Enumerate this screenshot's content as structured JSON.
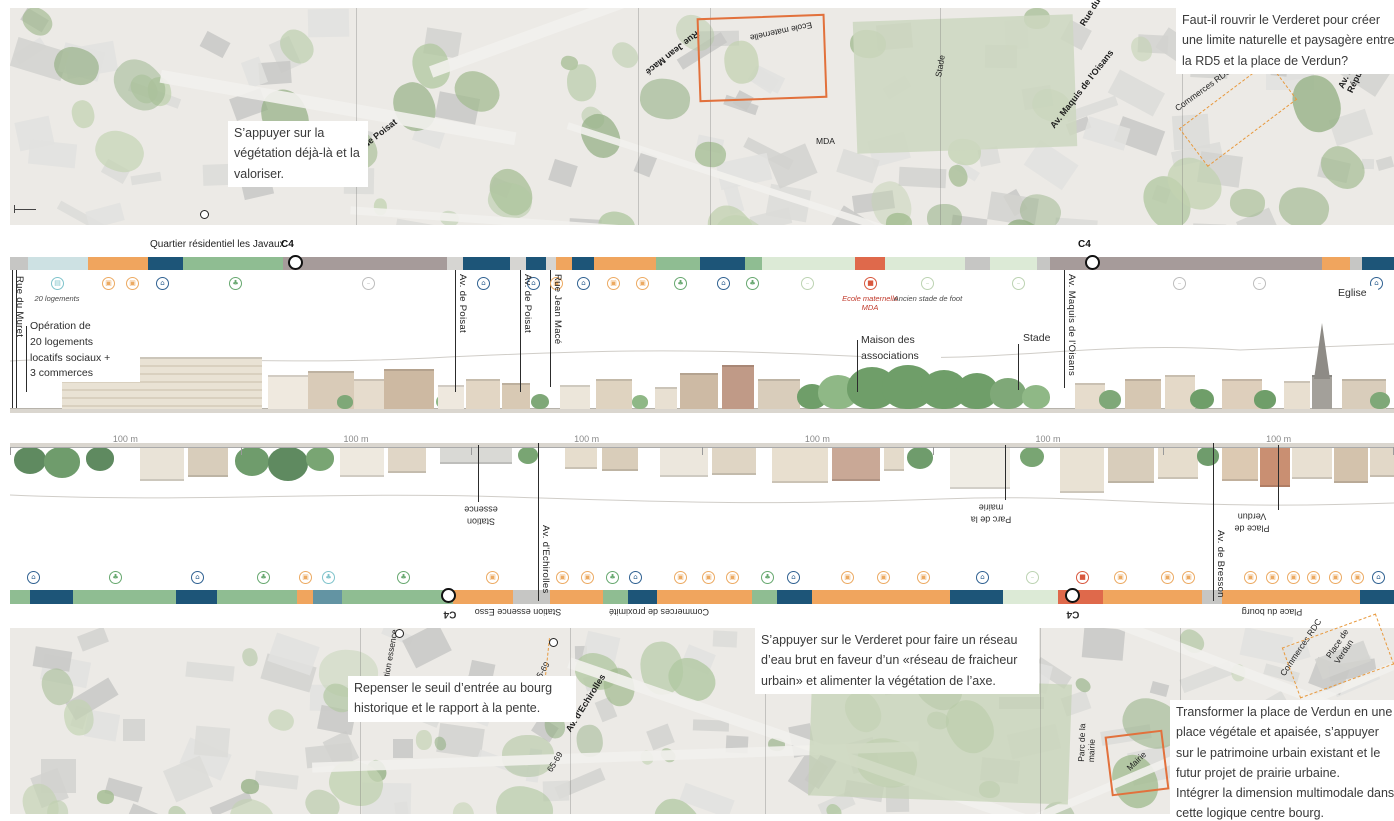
{
  "palette": {
    "gray": "#c6c6c4",
    "lgray": "#d6d5d2",
    "lblue": "#cde1e3",
    "orange": "#f0a55e",
    "navy": "#1d5578",
    "green": "#8fbd92",
    "mauve": "#a69b9a",
    "pgreen": "#dcead6",
    "red": "#df694b",
    "slate": "#6394a3",
    "icon_orange": "#ecaa62",
    "icon_navy": "#2f6191",
    "icon_green": "#67a86f",
    "icon_gray": "#bdbdbd",
    "icon_teal": "#7fc3cb",
    "icon_red": "#d8573d",
    "icon_pale": "#bcd3b2",
    "annotation_orange": "#e2713c"
  },
  "top_map": {
    "notes": [
      {
        "text": "S’appuyer sur la végétation déjà-là et la valoriser.",
        "x": 228,
        "y": 121,
        "w": 128
      },
      {
        "text": "Faut-il rouvrir le Verderet pour créer une limite naturelle et paysagère entre la RD5 et la place de Verdun?",
        "x": 1176,
        "y": 8,
        "w": 214
      }
    ],
    "road_labels": [
      {
        "text": "Av. de Poisat",
        "x": 352,
        "y": 150,
        "rot": -38,
        "bold": true
      },
      {
        "text": "Rue Jean Macé",
        "x": 698,
        "y": 28,
        "rot": 142,
        "bold": true
      },
      {
        "text": "Ecole maternelle",
        "x": 812,
        "y": 20,
        "rot": 168,
        "bold": false
      },
      {
        "text": "MDA",
        "x": 816,
        "y": 136,
        "rot": 0,
        "bold": false
      },
      {
        "text": "Stade",
        "x": 938,
        "y": 72,
        "rot": -80,
        "bold": false
      },
      {
        "text": "Rue du château",
        "x": 1082,
        "y": 20,
        "rot": -58,
        "bold": true
      },
      {
        "text": "Av. Maquis de l'Oisans",
        "x": 1052,
        "y": 122,
        "rot": -52,
        "bold": true
      },
      {
        "text": "Commerces RDC",
        "x": 1176,
        "y": 104,
        "rot": -36,
        "bold": false
      },
      {
        "text": "Av. de la République",
        "x": 1345,
        "y": 80,
        "rot": -64,
        "bold": true
      }
    ],
    "outlines": [
      {
        "type": "solid",
        "x": 698,
        "y": 16,
        "w": 128,
        "h": 84,
        "rot": -2
      },
      {
        "type": "dash",
        "x": 1182,
        "y": 90,
        "w": 112,
        "h": 48,
        "rot": -37
      }
    ],
    "circle_markers": [
      {
        "x": 200,
        "y": 210
      }
    ]
  },
  "band1": {
    "quartier_label": "Quartier résidentiel les Javaux",
    "c4_label": "C4",
    "c4_label_positions": [
      {
        "x": 281,
        "y": 239
      },
      {
        "x": 1078,
        "y": 239
      }
    ],
    "c4_markers": [
      296,
      1093
    ],
    "segments": [
      [
        18,
        "gray"
      ],
      [
        60,
        "lblue"
      ],
      [
        60,
        "orange"
      ],
      [
        35,
        "navy"
      ],
      [
        100,
        "green"
      ],
      [
        164,
        "mauve"
      ],
      [
        16,
        "lgray"
      ],
      [
        47,
        "navy"
      ],
      [
        16,
        "lgray"
      ],
      [
        20,
        "navy"
      ],
      [
        10,
        "lgray"
      ],
      [
        16,
        "orange"
      ],
      [
        22,
        "navy"
      ],
      [
        62,
        "orange"
      ],
      [
        44,
        "green"
      ],
      [
        45,
        "navy"
      ],
      [
        17,
        "green"
      ],
      [
        93,
        "pgreen"
      ],
      [
        30,
        "red"
      ],
      [
        80,
        "pgreen"
      ],
      [
        25,
        "gray"
      ],
      [
        47,
        "pgreen"
      ],
      [
        13,
        "gray"
      ],
      [
        272,
        "mauve"
      ],
      [
        28,
        "orange"
      ],
      [
        12,
        "gray"
      ],
      [
        32,
        "navy"
      ]
    ],
    "icons": [
      [
        57,
        "icon_teal",
        "building"
      ],
      [
        108,
        "icon_orange",
        "shop"
      ],
      [
        132,
        "icon_orange",
        "shop"
      ],
      [
        162,
        "icon_navy",
        "house"
      ],
      [
        235,
        "icon_green",
        "tree"
      ],
      [
        368,
        "icon_gray",
        "neutral"
      ],
      [
        483,
        "icon_navy",
        "house"
      ],
      [
        533,
        "icon_navy",
        "house"
      ],
      [
        556,
        "icon_orange",
        "shop"
      ],
      [
        583,
        "icon_navy",
        "house"
      ],
      [
        613,
        "icon_orange",
        "shop"
      ],
      [
        642,
        "icon_orange",
        "shop"
      ],
      [
        680,
        "icon_green",
        "tree"
      ],
      [
        723,
        "icon_navy",
        "house"
      ],
      [
        752,
        "icon_green",
        "tree"
      ],
      [
        807,
        "icon_pale",
        "neutral"
      ],
      [
        870,
        "icon_red",
        "school"
      ],
      [
        927,
        "icon_pale",
        "neutral"
      ],
      [
        1018,
        "icon_pale",
        "neutral"
      ],
      [
        1179,
        "icon_gray",
        "neutral"
      ],
      [
        1259,
        "icon_gray",
        "neutral"
      ],
      [
        1376,
        "icon_navy",
        "house"
      ]
    ],
    "icon_captions": [
      {
        "text": "20 logements",
        "x": 57,
        "y": 294,
        "color": "#4a4a4a"
      },
      {
        "text": "Ecole maternelle\nMDA",
        "x": 870,
        "y": 294,
        "color": "#c0392b"
      },
      {
        "text": "Ancien stade de foot",
        "x": 928,
        "y": 294,
        "color": "#4a4a4a"
      }
    ],
    "streets": [
      {
        "name": "Rue du Muret",
        "x": 12,
        "y1": 270,
        "y2": 408,
        "ly": 276
      },
      {
        "name": "",
        "x": 16,
        "y1": 270,
        "y2": 408,
        "ly": 0
      },
      {
        "name": "",
        "x": 26,
        "y1": 326,
        "y2": 392,
        "ly": 0
      },
      {
        "name": "Av. de Poisat",
        "x": 455,
        "y1": 270,
        "y2": 392,
        "ly": 274
      },
      {
        "name": "Av. de Poisat",
        "x": 520,
        "y1": 270,
        "y2": 392,
        "ly": 274
      },
      {
        "name": "Rue Jean Macé",
        "x": 550,
        "y1": 270,
        "y2": 387,
        "ly": 274
      },
      {
        "name": "Av. Maquis de l'Oisans",
        "x": 1064,
        "y1": 270,
        "y2": 388,
        "ly": 274
      },
      {
        "name": "",
        "x": 857,
        "y1": 340,
        "y2": 392,
        "ly": 0
      },
      {
        "name": "",
        "x": 1018,
        "y1": 344,
        "y2": 390,
        "ly": 0
      }
    ],
    "callouts": [
      {
        "text": "Opération de\n20 logements\nlocatifs sociaux +\n3 commerces",
        "x": 30,
        "y": 319,
        "w": 110
      },
      {
        "text": "Maison des\nassociations",
        "x": 861,
        "y": 333,
        "w": 80
      },
      {
        "text": "Stade",
        "x": 1023,
        "y": 331,
        "w": 40
      },
      {
        "text": "Eglise",
        "x": 1338,
        "y": 286,
        "w": 40
      }
    ]
  },
  "scale": {
    "label": "100 m",
    "segments": 6
  },
  "band2": {
    "c4_label": "C4",
    "c4_markers": [
      449,
      1073
    ],
    "segments": [
      [
        20,
        "green"
      ],
      [
        43,
        "navy"
      ],
      [
        103,
        "green"
      ],
      [
        41,
        "navy"
      ],
      [
        80,
        "green"
      ],
      [
        16,
        "orange"
      ],
      [
        29,
        "slate"
      ],
      [
        111,
        "green"
      ],
      [
        60,
        "orange"
      ],
      [
        37,
        "gray"
      ],
      [
        53,
        "orange"
      ],
      [
        25,
        "green"
      ],
      [
        29,
        "navy"
      ],
      [
        95,
        "orange"
      ],
      [
        25,
        "green"
      ],
      [
        35,
        "navy"
      ],
      [
        138,
        "orange"
      ],
      [
        53,
        "navy"
      ],
      [
        55,
        "pgreen"
      ],
      [
        45,
        "red"
      ],
      [
        99,
        "orange"
      ],
      [
        20,
        "gray"
      ],
      [
        138,
        "orange"
      ],
      [
        34,
        "navy"
      ]
    ],
    "icons": [
      [
        33,
        "icon_navy",
        "house"
      ],
      [
        115,
        "icon_green",
        "tree"
      ],
      [
        197,
        "icon_navy",
        "house"
      ],
      [
        263,
        "icon_green",
        "tree"
      ],
      [
        305,
        "icon_orange",
        "shop"
      ],
      [
        328,
        "icon_teal",
        "tree"
      ],
      [
        403,
        "icon_green",
        "tree"
      ],
      [
        492,
        "icon_orange",
        "shop"
      ],
      [
        562,
        "icon_orange",
        "shop"
      ],
      [
        587,
        "icon_orange",
        "shop"
      ],
      [
        612,
        "icon_green",
        "tree"
      ],
      [
        635,
        "icon_navy",
        "house"
      ],
      [
        680,
        "icon_orange",
        "shop"
      ],
      [
        708,
        "icon_orange",
        "shop"
      ],
      [
        732,
        "icon_orange",
        "shop"
      ],
      [
        767,
        "icon_green",
        "tree"
      ],
      [
        793,
        "icon_navy",
        "house"
      ],
      [
        847,
        "icon_orange",
        "shop"
      ],
      [
        883,
        "icon_orange",
        "shop"
      ],
      [
        923,
        "icon_orange",
        "shop"
      ],
      [
        982,
        "icon_navy",
        "house"
      ],
      [
        1032,
        "icon_pale",
        "neutral"
      ],
      [
        1082,
        "icon_red",
        "school"
      ],
      [
        1120,
        "icon_orange",
        "shop"
      ],
      [
        1167,
        "icon_orange",
        "shop"
      ],
      [
        1188,
        "icon_orange",
        "shop"
      ],
      [
        1250,
        "icon_orange",
        "shop"
      ],
      [
        1272,
        "icon_orange",
        "shop"
      ],
      [
        1293,
        "icon_orange",
        "shop"
      ],
      [
        1313,
        "icon_orange",
        "shop"
      ],
      [
        1335,
        "icon_orange",
        "shop"
      ],
      [
        1357,
        "icon_orange",
        "shop"
      ],
      [
        1378,
        "icon_navy",
        "house"
      ]
    ],
    "streets": [
      {
        "name": "Av. d'Echirolles",
        "x": 538,
        "y1": 443,
        "y2": 601,
        "ly": 525
      },
      {
        "name": "Av. de Bresson",
        "x": 1213,
        "y1": 443,
        "y2": 601,
        "ly": 530
      },
      {
        "name": "",
        "x": 478,
        "y1": 445,
        "y2": 502,
        "ly": 0
      },
      {
        "name": "",
        "x": 1005,
        "y1": 445,
        "y2": 500,
        "ly": 0
      },
      {
        "name": "",
        "x": 1278,
        "y1": 445,
        "y2": 510,
        "ly": 0
      }
    ],
    "elevation_labels_flipped": [
      {
        "text": "Station\nessence",
        "x": 452,
        "y": 503,
        "w": 58,
        "bold": false
      },
      {
        "text": "Parc de la\nmairie",
        "x": 960,
        "y": 501,
        "w": 62,
        "bold": false
      },
      {
        "text": "Place de\nVerdun",
        "x": 1222,
        "y": 510,
        "w": 60,
        "bold": false
      }
    ],
    "bar_labels_flipped": [
      {
        "text": "C4",
        "x": 440,
        "y": 607,
        "w": 20,
        "bold": true
      },
      {
        "text": "Station essence Esso",
        "x": 462,
        "y": 606,
        "w": 112,
        "bold": false
      },
      {
        "text": "Commerces de proximité",
        "x": 600,
        "y": 606,
        "w": 118,
        "bold": false
      },
      {
        "text": "C4",
        "x": 1063,
        "y": 607,
        "w": 20,
        "bold": true
      },
      {
        "text": "Place du bourg",
        "x": 1226,
        "y": 606,
        "w": 92,
        "bold": false
      }
    ]
  },
  "bottom_map": {
    "notes": [
      {
        "text": "Repenser le seuil d’entrée au bourg historique et le rapport à la pente.",
        "x": 348,
        "y": 676,
        "w": 216
      },
      {
        "text": "S’appuyer sur le Verderet pour faire un réseau d’eau brut en faveur d’un «réseau de fraicheur urbain» et alimenter la végétation de l’axe.",
        "x": 755,
        "y": 628,
        "w": 272
      },
      {
        "text": "Transformer la place de Verdun en une place végétale et apaisée, s’appuyer sur le patrimoine urbain existant et le futur projet de prairie urbaine.\nIntégrer la dimension multimodale dans cette logique centre bourg.",
        "x": 1170,
        "y": 700,
        "w": 222
      }
    ],
    "road_labels": [
      {
        "text": "Station essence",
        "x": 384,
        "y": 684,
        "rot": -80,
        "bold": false
      },
      {
        "text": "65-69",
        "x": 536,
        "y": 676,
        "rot": -58,
        "bold": false
      },
      {
        "text": "Av. d'Echirolles",
        "x": 568,
        "y": 726,
        "rot": -58,
        "bold": true
      },
      {
        "text": "65-69",
        "x": 549,
        "y": 766,
        "rot": -58,
        "bold": false
      },
      {
        "text": "Parc de la\nmairie",
        "x": 1086,
        "y": 752,
        "rot": -88,
        "bold": false
      },
      {
        "text": "Mairie",
        "x": 1128,
        "y": 764,
        "rot": -44,
        "bold": false
      },
      {
        "text": "Place de\nVerdun",
        "x": 1332,
        "y": 650,
        "rot": -56,
        "bold": false
      },
      {
        "text": "Commerces RDC",
        "x": 1282,
        "y": 670,
        "rot": -56,
        "bold": false
      }
    ],
    "outlines": [
      {
        "type": "solid",
        "x": 1108,
        "y": 733,
        "w": 58,
        "h": 60,
        "rot": -7
      },
      {
        "type": "dash",
        "x": 1288,
        "y": 629,
        "w": 100,
        "h": 54,
        "rot": -20
      },
      {
        "type": "dashv",
        "x": 545,
        "y": 638,
        "w": 1,
        "h": 76,
        "rot": 6
      },
      {
        "type": "dashh",
        "x": 770,
        "y": 628,
        "w": 252,
        "h": 1,
        "rot": 0
      }
    ],
    "circle_markers": [
      {
        "x": 395,
        "y": 629
      },
      {
        "x": 549,
        "y": 638
      }
    ]
  }
}
